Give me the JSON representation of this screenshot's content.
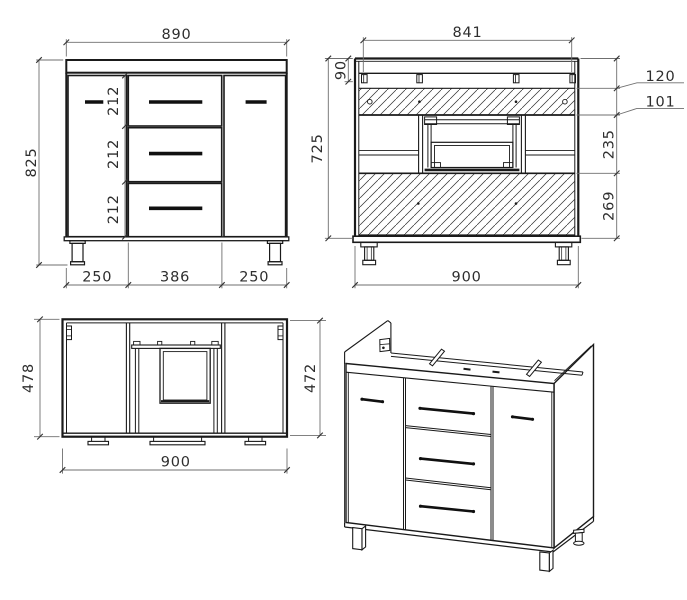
{
  "drawing": {
    "colors": {
      "background": "#ffffff",
      "geometry_line": "#1a1a1a",
      "dimension_line": "#6f6f6f",
      "dimension_text": "#2e2e2e"
    },
    "views": {
      "front_view": {
        "dims": {
          "overall_width": "890",
          "overall_height": "825",
          "drawer_heights": [
            "212",
            "212",
            "212"
          ],
          "bottom_segments": [
            "250",
            "386",
            "250"
          ]
        }
      },
      "back_view": {
        "dims": {
          "inner_width": "841",
          "top_offset": "90",
          "carcass_height": "725",
          "callout_top": "120",
          "callout_stretcher": "101",
          "middle_section": "235",
          "lower_panel": "269",
          "overall_width": "900"
        }
      },
      "top_view": {
        "dims": {
          "depth_left": "478",
          "depth_right": "472",
          "overall_width": "900"
        }
      }
    }
  }
}
